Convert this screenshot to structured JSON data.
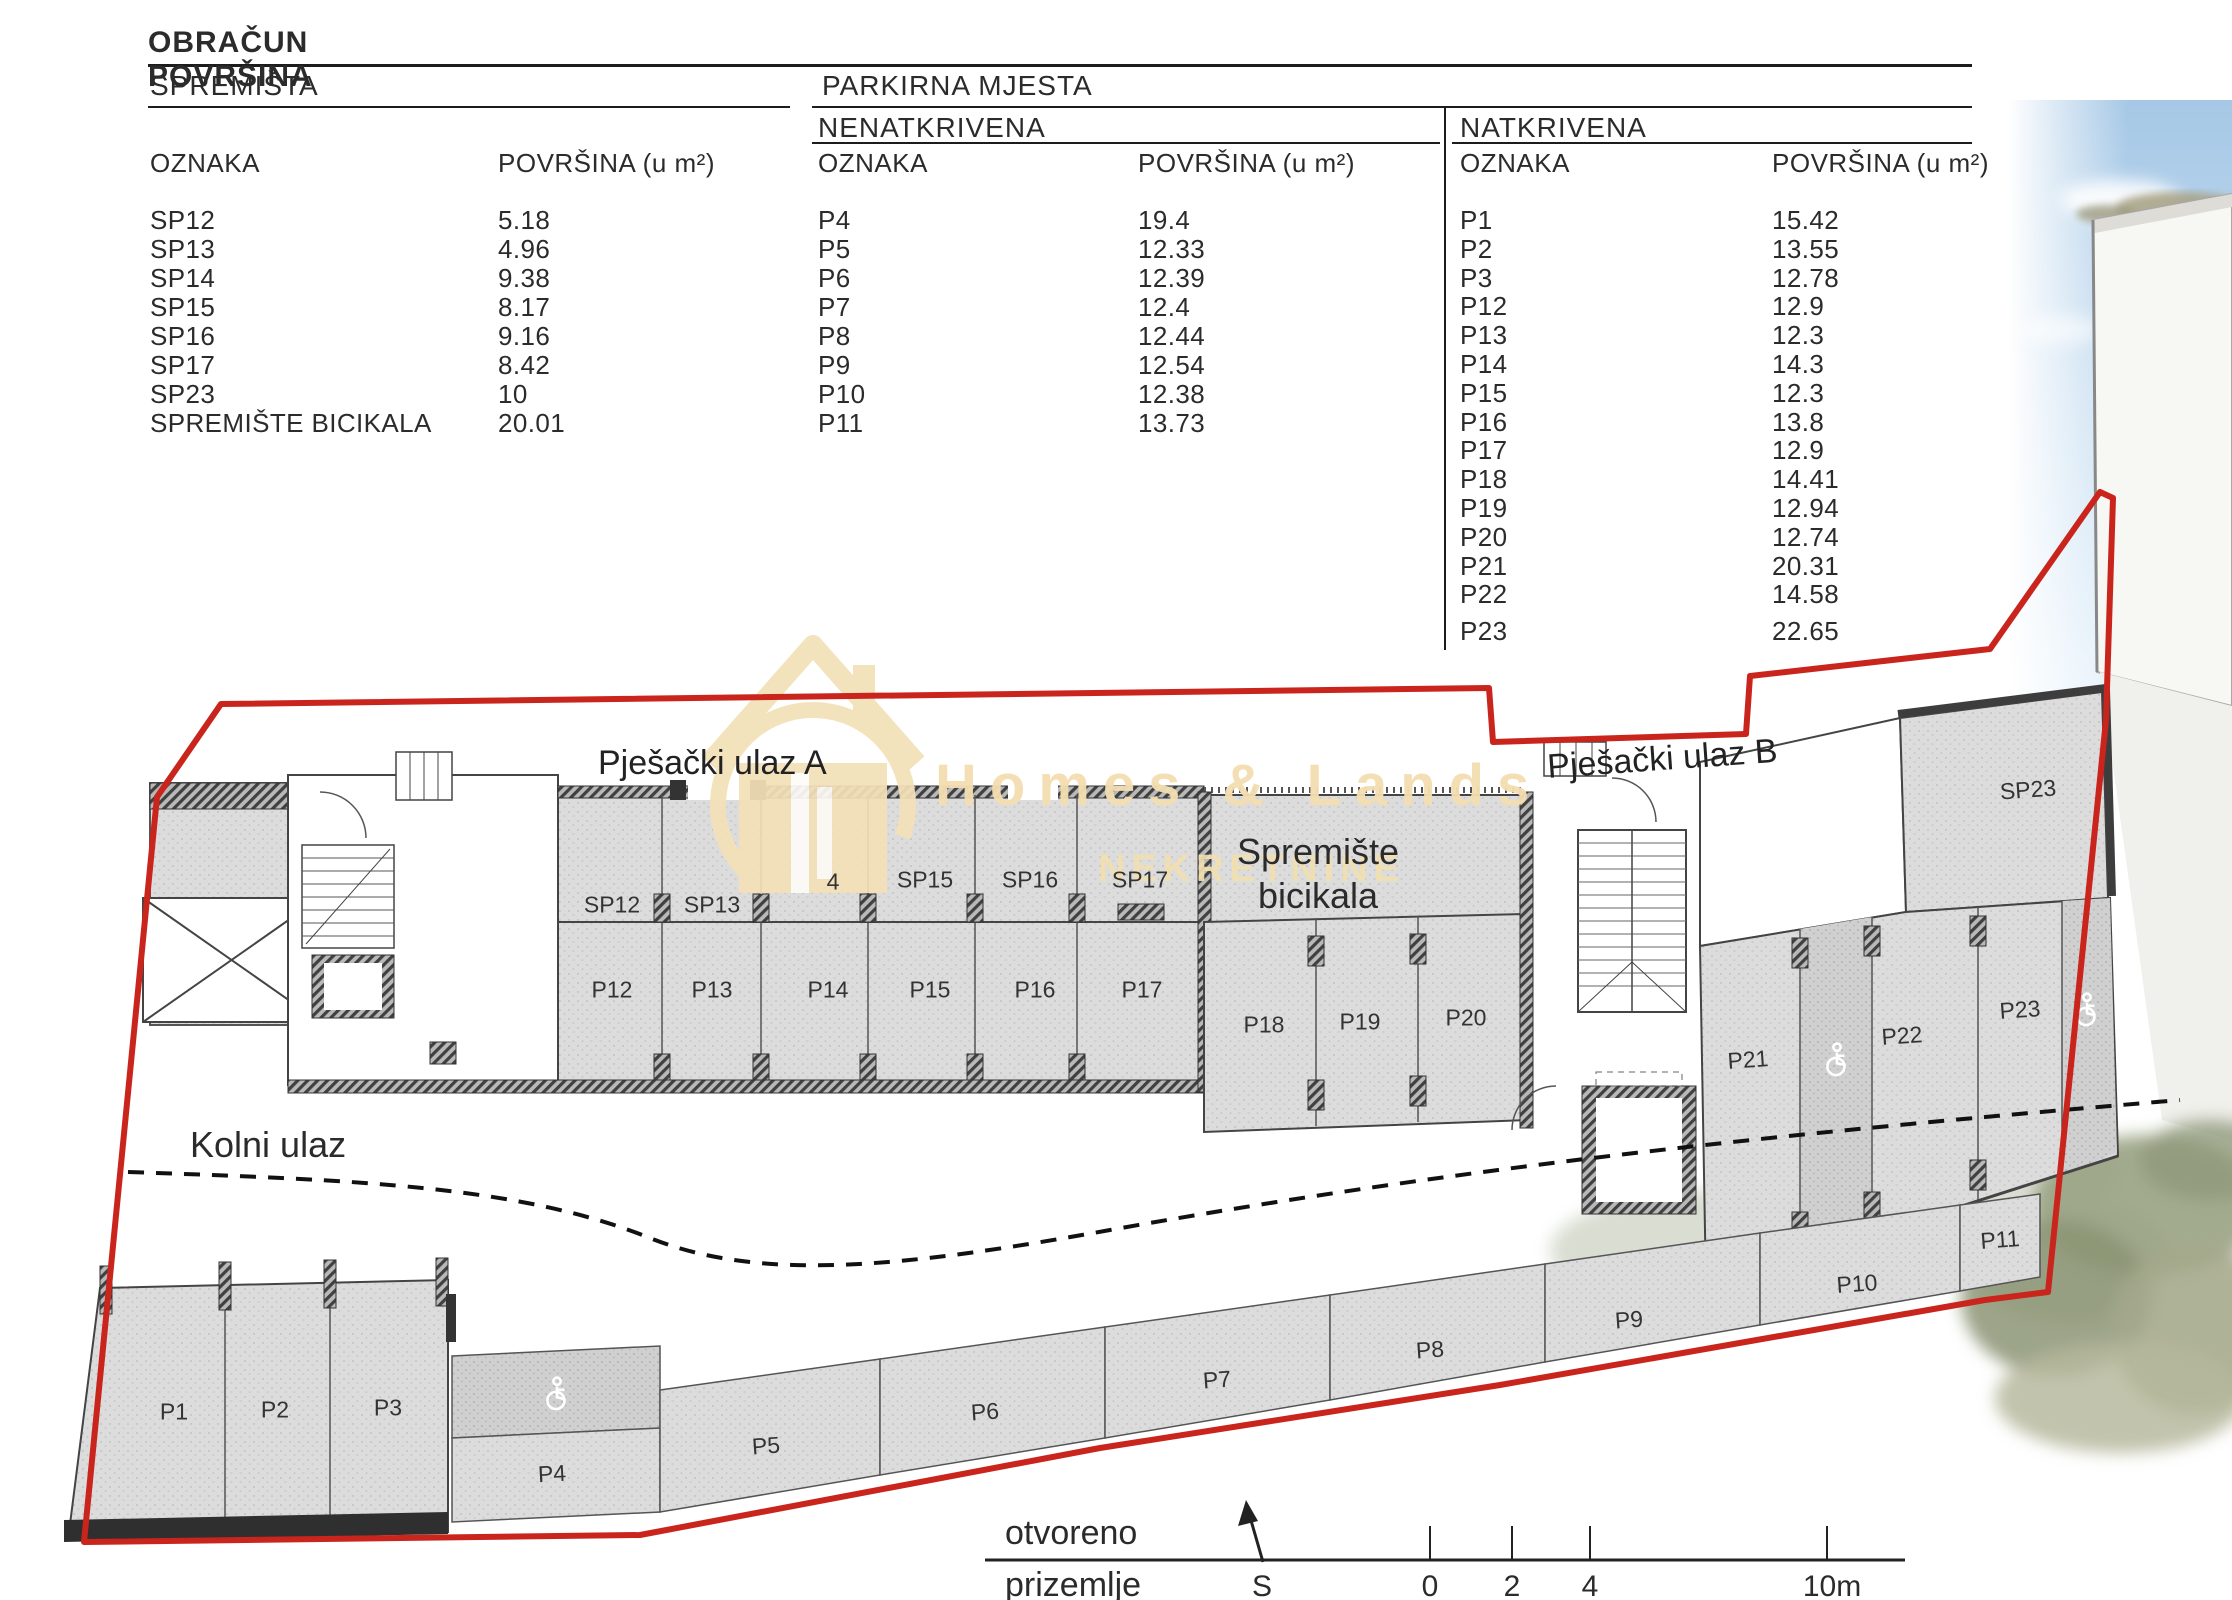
{
  "title": "OBRAČUN POVRŠINA",
  "columns": {
    "oznaka": "OZNAKA",
    "povrsina": "POVRŠINA (u m²)"
  },
  "spremista": {
    "header": "SPREMIŠTA",
    "rows": [
      [
        "SP12",
        "5.18"
      ],
      [
        "SP13",
        "4.96"
      ],
      [
        "SP14",
        "9.38"
      ],
      [
        "SP15",
        "8.17"
      ],
      [
        "SP16",
        "9.16"
      ],
      [
        "SP17",
        "8.42"
      ],
      [
        "SP23",
        "10"
      ],
      [
        "SPREMIŠTE BICIKALA",
        "20.01"
      ]
    ]
  },
  "parkirna": {
    "header": "PARKIRNA MJESTA",
    "nenatkrivena": {
      "header": "NENATKRIVENA",
      "rows": [
        [
          "P4",
          "19.4"
        ],
        [
          "P5",
          "12.33"
        ],
        [
          "P6",
          "12.39"
        ],
        [
          "P7",
          "12.4"
        ],
        [
          "P8",
          "12.44"
        ],
        [
          "P9",
          "12.54"
        ],
        [
          "P10",
          "12.38"
        ],
        [
          "P11",
          "13.73"
        ]
      ]
    },
    "natkrivena": {
      "header": "NATKRIVENA",
      "rows": [
        [
          "P1",
          "15.42"
        ],
        [
          "P2",
          "13.55"
        ],
        [
          "P3",
          "12.78"
        ],
        [
          "P12",
          "12.9"
        ],
        [
          "P13",
          "12.3"
        ],
        [
          "P14",
          "14.3"
        ],
        [
          "P15",
          "12.3"
        ],
        [
          "P16",
          "13.8"
        ],
        [
          "P17",
          "12.9"
        ],
        [
          "P18",
          "14.41"
        ],
        [
          "P19",
          "12.94"
        ],
        [
          "P20",
          "12.74"
        ],
        [
          "P21",
          "20.31"
        ],
        [
          "P22",
          "14.58"
        ],
        [
          "P23",
          "22.65"
        ]
      ]
    }
  },
  "plan": {
    "entrance_a": "Pješački ulaz A",
    "entrance_b": "Pješački ulaz B",
    "kolni_ulaz": "Kolni ulaz",
    "bike_line1": "Spremište",
    "bike_line2": "bicikala",
    "rooms": [
      {
        "t": "SP12",
        "x": 612,
        "y": 905
      },
      {
        "t": "SP13",
        "x": 712,
        "y": 905
      },
      {
        "t": "4",
        "x": 833,
        "y": 882
      },
      {
        "t": "SP15",
        "x": 925,
        "y": 880
      },
      {
        "t": "SP16",
        "x": 1030,
        "y": 880
      },
      {
        "t": "SP17",
        "x": 1140,
        "y": 880
      },
      {
        "t": "P12",
        "x": 612,
        "y": 990
      },
      {
        "t": "P13",
        "x": 712,
        "y": 990
      },
      {
        "t": "P14",
        "x": 828,
        "y": 990
      },
      {
        "t": "P15",
        "x": 930,
        "y": 990
      },
      {
        "t": "P16",
        "x": 1035,
        "y": 990
      },
      {
        "t": "P17",
        "x": 1142,
        "y": 990
      },
      {
        "t": "P18",
        "x": 1264,
        "y": 1025
      },
      {
        "t": "P19",
        "x": 1360,
        "y": 1022
      },
      {
        "t": "P20",
        "x": 1466,
        "y": 1018
      },
      {
        "t": "SP23",
        "x": 2028,
        "y": 790,
        "rot": -4
      },
      {
        "t": "P21",
        "x": 1748,
        "y": 1060,
        "rot": -4
      },
      {
        "t": "P22",
        "x": 1902,
        "y": 1036,
        "rot": -4
      },
      {
        "t": "P23",
        "x": 2020,
        "y": 1010,
        "rot": -4
      },
      {
        "t": "P1",
        "x": 174,
        "y": 1412
      },
      {
        "t": "P2",
        "x": 275,
        "y": 1410
      },
      {
        "t": "P3",
        "x": 388,
        "y": 1408
      },
      {
        "t": "P4",
        "x": 552,
        "y": 1474,
        "rot": -3
      },
      {
        "t": "P5",
        "x": 766,
        "y": 1446,
        "rot": -4
      },
      {
        "t": "P6",
        "x": 985,
        "y": 1412,
        "rot": -4
      },
      {
        "t": "P7",
        "x": 1217,
        "y": 1380,
        "rot": -4
      },
      {
        "t": "P8",
        "x": 1430,
        "y": 1350,
        "rot": -4
      },
      {
        "t": "P9",
        "x": 1629,
        "y": 1320,
        "rot": -4
      },
      {
        "t": "P10",
        "x": 1857,
        "y": 1284,
        "rot": -4
      },
      {
        "t": "P11",
        "x": 2000,
        "y": 1240,
        "rot": -4
      }
    ],
    "legend": {
      "otvoreno": "otvoreno",
      "prizemlje": "prizemlje",
      "north": "S",
      "scale_ticks": [
        "0",
        "2",
        "4",
        "10m"
      ]
    }
  },
  "watermark": {
    "line1": "Homes & Lands",
    "line2": "NEKRETNINE"
  },
  "colors": {
    "boundary_red": "#c9251c",
    "watermark_gold": "#f3e0b6",
    "plan_fill": "#dcdcdc"
  }
}
